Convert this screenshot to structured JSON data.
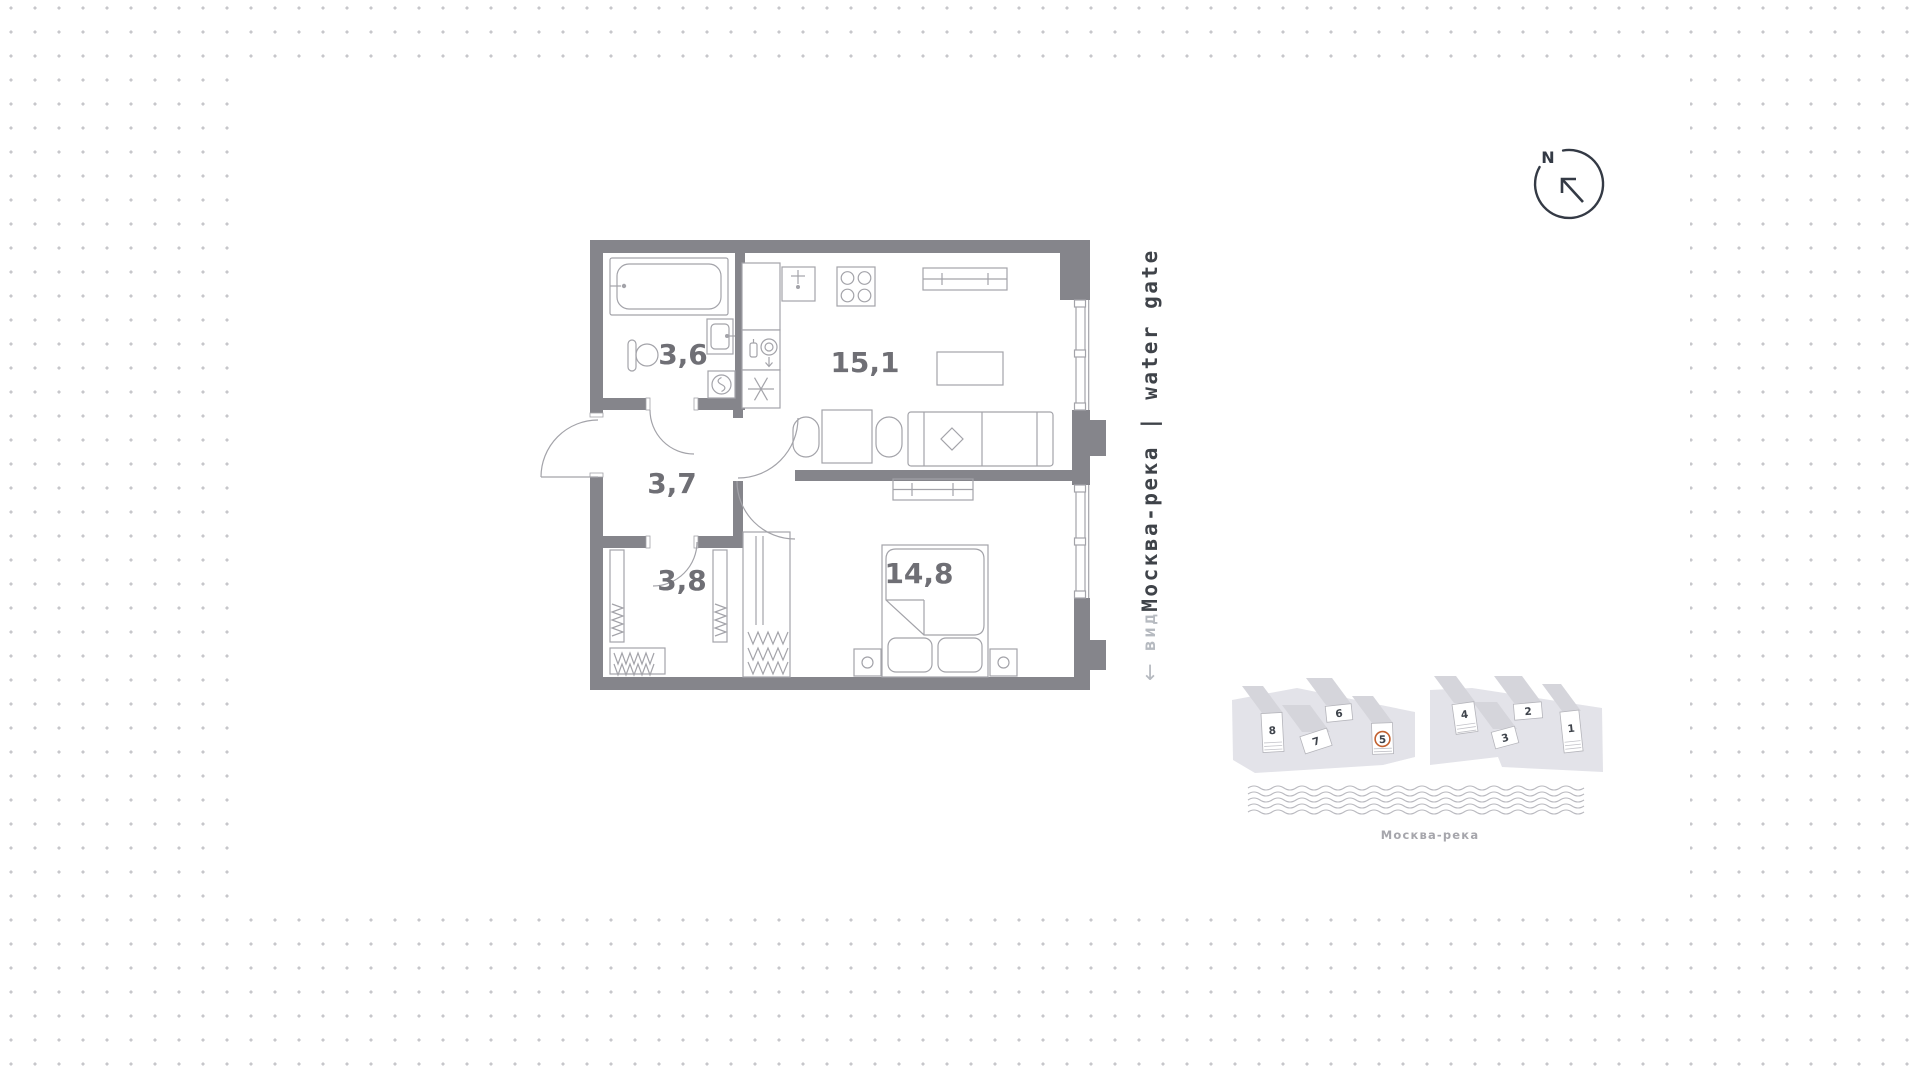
{
  "page": {
    "background_dot_color": "#c7c7cb",
    "canvas_color": "#ffffff",
    "wall_color": "#85858b"
  },
  "compass": {
    "north_label": "N"
  },
  "orientation": {
    "river_view_label": "Москва-река | water gate",
    "view_word": "вид",
    "view_arrow": "↓"
  },
  "floor_plan": {
    "rooms": [
      {
        "name": "bathroom",
        "area": "3,6"
      },
      {
        "name": "hallway",
        "area": "3,7"
      },
      {
        "name": "wardrobe",
        "area": "3,8"
      },
      {
        "name": "kitchen-living-room",
        "area": "15,1"
      },
      {
        "name": "bedroom",
        "area": "14,8"
      }
    ]
  },
  "site_plan": {
    "river_label": "Москва-река",
    "current_building": "5",
    "accent_color": "#c2602f",
    "buildings": [
      {
        "number": "1"
      },
      {
        "number": "2"
      },
      {
        "number": "3"
      },
      {
        "number": "4"
      },
      {
        "number": "5"
      },
      {
        "number": "6"
      },
      {
        "number": "7"
      },
      {
        "number": "8"
      }
    ]
  }
}
